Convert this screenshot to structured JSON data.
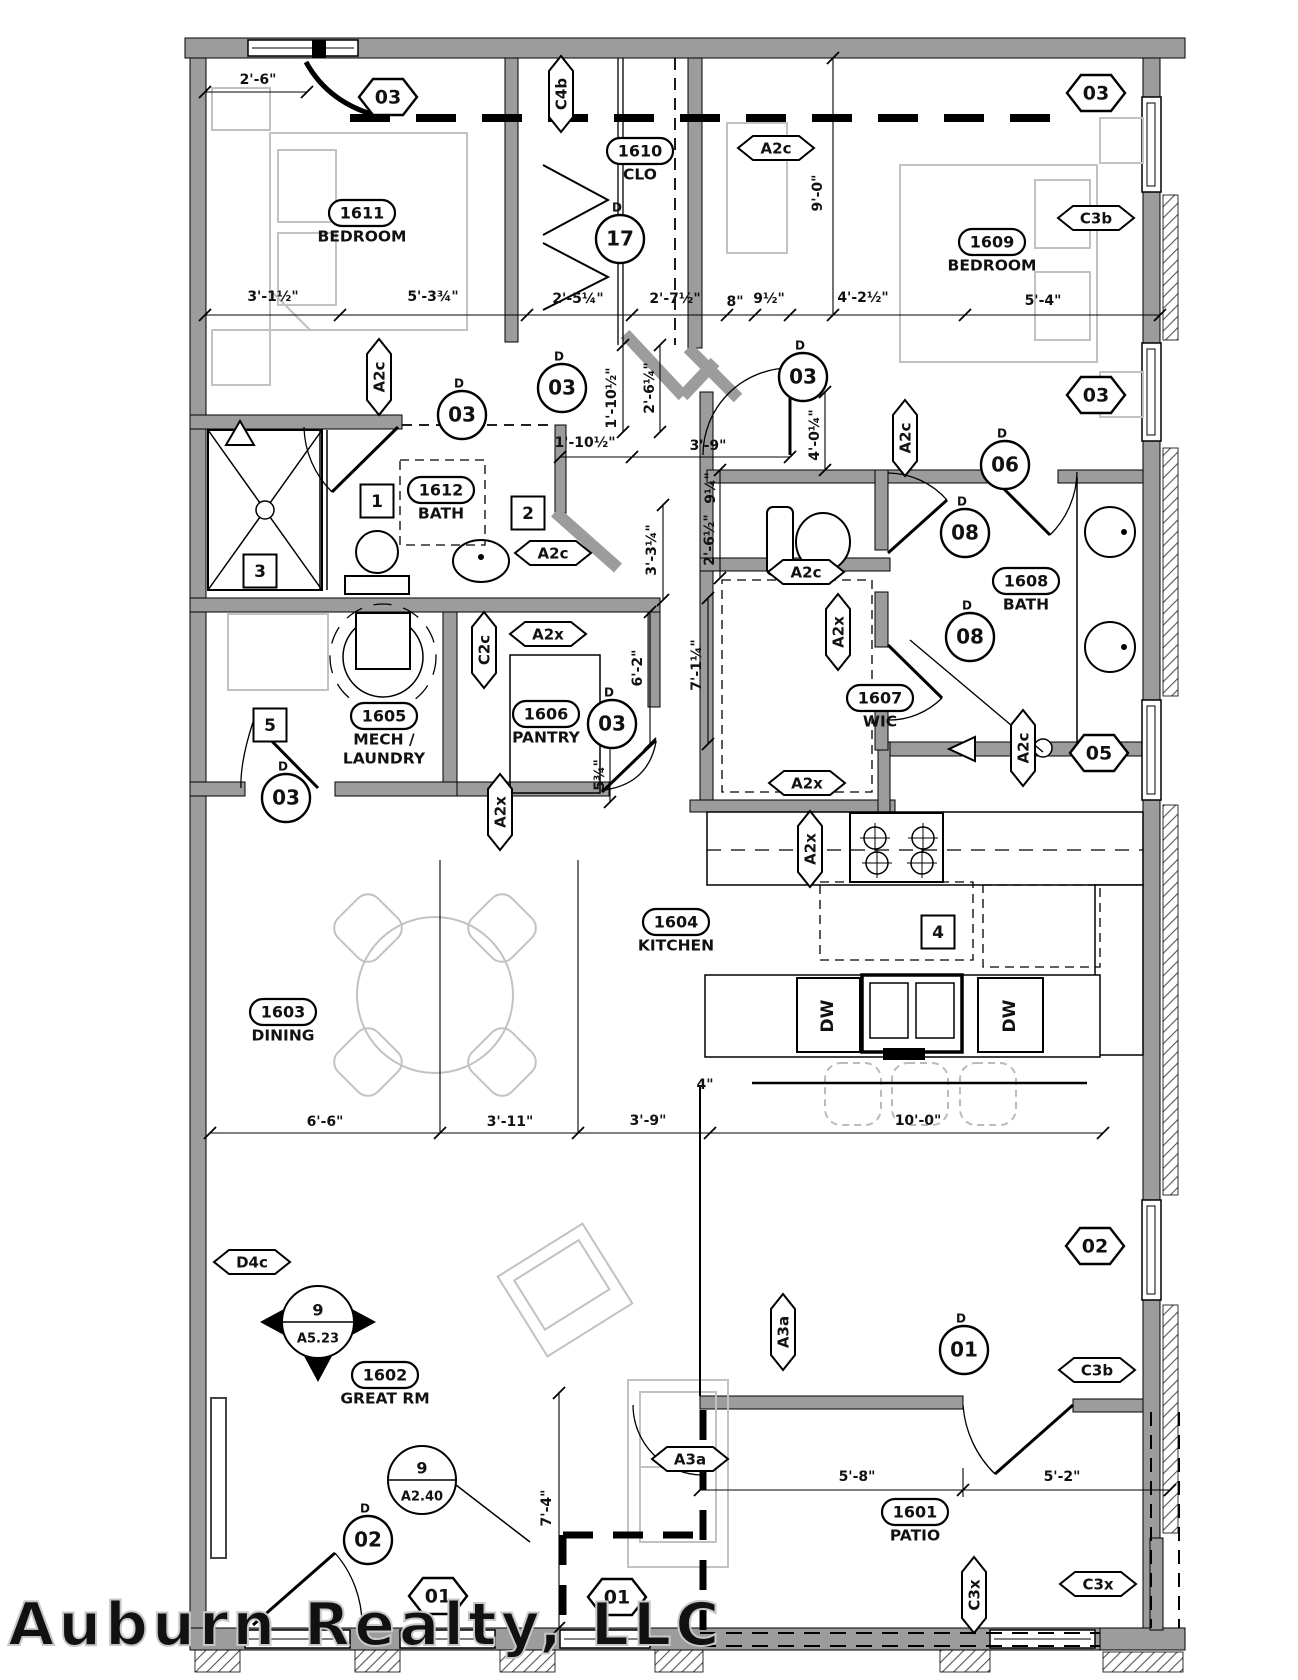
{
  "watermark": "Auburn Realty, LLC",
  "door_letter": "D",
  "colors": {
    "wall_gray": "#9c9c9c",
    "furniture_gray": "#c2c2c2",
    "line": "#111111",
    "watermark_gray": "#c8c8c8"
  },
  "rooms": [
    {
      "num": "1611",
      "name": "BEDROOM",
      "x": 362,
      "y": 213
    },
    {
      "num": "1610",
      "name": "CLO",
      "x": 640,
      "y": 151
    },
    {
      "num": "1609",
      "name": "BEDROOM",
      "x": 992,
      "y": 242
    },
    {
      "num": "1612",
      "name": "BATH",
      "x": 441,
      "y": 490
    },
    {
      "num": "1608",
      "name": "BATH",
      "x": 1026,
      "y": 581
    },
    {
      "num": "1607",
      "name": "WIC",
      "x": 880,
      "y": 698
    },
    {
      "num": "1605",
      "name": "MECH /",
      "name2": "LAUNDRY",
      "x": 384,
      "y": 716
    },
    {
      "num": "1606",
      "name": "PANTRY",
      "x": 546,
      "y": 714
    },
    {
      "num": "1604",
      "name": "KITCHEN",
      "x": 676,
      "y": 922
    },
    {
      "num": "1603",
      "name": "DINING",
      "x": 283,
      "y": 1012
    },
    {
      "num": "1602",
      "name": "GREAT RM",
      "x": 385,
      "y": 1375
    },
    {
      "num": "1601",
      "name": "PATIO",
      "x": 915,
      "y": 1512
    }
  ],
  "door_tags": [
    {
      "n": "17",
      "x": 620,
      "y": 239
    },
    {
      "n": "03",
      "x": 462,
      "y": 415
    },
    {
      "n": "03",
      "x": 562,
      "y": 388
    },
    {
      "n": "03",
      "x": 803,
      "y": 377
    },
    {
      "n": "03",
      "x": 286,
      "y": 798
    },
    {
      "n": "03",
      "x": 612,
      "y": 724
    },
    {
      "n": "06",
      "x": 1005,
      "y": 465
    },
    {
      "n": "08",
      "x": 965,
      "y": 533
    },
    {
      "n": "08",
      "x": 970,
      "y": 637
    },
    {
      "n": "01",
      "x": 964,
      "y": 1350
    },
    {
      "n": "02",
      "x": 368,
      "y": 1540
    }
  ],
  "window_tags": [
    {
      "n": "03",
      "x": 388,
      "y": 97
    },
    {
      "n": "03",
      "x": 1096,
      "y": 93
    },
    {
      "n": "03",
      "x": 1096,
      "y": 395
    },
    {
      "n": "05",
      "x": 1099,
      "y": 753
    },
    {
      "n": "02",
      "x": 1095,
      "y": 1246
    },
    {
      "n": "01",
      "x": 438,
      "y": 1596
    },
    {
      "n": "01",
      "x": 617,
      "y": 1597
    }
  ],
  "wall_tags": [
    {
      "t": "C4b",
      "x": 561,
      "y": 94,
      "v": 1
    },
    {
      "t": "A2c",
      "x": 776,
      "y": 148
    },
    {
      "t": "A2c",
      "x": 379,
      "y": 377,
      "v": 1
    },
    {
      "t": "A2c",
      "x": 553,
      "y": 553
    },
    {
      "t": "A2c",
      "x": 806,
      "y": 572
    },
    {
      "t": "A2c",
      "x": 905,
      "y": 438,
      "v": 1
    },
    {
      "t": "A2x",
      "x": 838,
      "y": 632,
      "v": 1
    },
    {
      "t": "A2x",
      "x": 548,
      "y": 634
    },
    {
      "t": "C2c",
      "x": 484,
      "y": 650,
      "v": 1
    },
    {
      "t": "A2x",
      "x": 807,
      "y": 783
    },
    {
      "t": "A2x",
      "x": 810,
      "y": 849,
      "v": 1
    },
    {
      "t": "A2x",
      "x": 500,
      "y": 812,
      "v": 1
    },
    {
      "t": "A2c",
      "x": 1023,
      "y": 748,
      "v": 1
    },
    {
      "t": "D4c",
      "x": 252,
      "y": 1262
    },
    {
      "t": "A3a",
      "x": 783,
      "y": 1332,
      "v": 1
    },
    {
      "t": "A3a",
      "x": 690,
      "y": 1459
    },
    {
      "t": "C3b",
      "x": 1096,
      "y": 218
    },
    {
      "t": "C3b",
      "x": 1097,
      "y": 1370
    },
    {
      "t": "C3x",
      "x": 974,
      "y": 1595,
      "v": 1
    },
    {
      "t": "C3x",
      "x": 1098,
      "y": 1584
    }
  ],
  "keynotes": [
    {
      "n": "1",
      "x": 377,
      "y": 501
    },
    {
      "n": "2",
      "x": 528,
      "y": 513
    },
    {
      "n": "3",
      "x": 260,
      "y": 571
    },
    {
      "n": "5",
      "x": 270,
      "y": 725
    },
    {
      "n": "4",
      "x": 938,
      "y": 932
    }
  ],
  "dims": [
    {
      "t": "2'-6\"",
      "x": 258,
      "y": 80
    },
    {
      "t": "3'-1½\"",
      "x": 273,
      "y": 297
    },
    {
      "t": "5'-3¾\"",
      "x": 433,
      "y": 297
    },
    {
      "t": "2'-5¼\"",
      "x": 578,
      "y": 299
    },
    {
      "t": "2'-7½\"",
      "x": 675,
      "y": 299
    },
    {
      "t": "8\"",
      "x": 735,
      "y": 302
    },
    {
      "t": "9½\"",
      "x": 769,
      "y": 299
    },
    {
      "t": "4'-2½\"",
      "x": 863,
      "y": 298
    },
    {
      "t": "5'-4\"",
      "x": 1043,
      "y": 301
    },
    {
      "t": "9'-0\"",
      "x": 818,
      "y": 193,
      "v": 1
    },
    {
      "t": "1'-10½\"",
      "x": 612,
      "y": 398,
      "v": 1
    },
    {
      "t": "2'-6¼\"",
      "x": 650,
      "y": 388,
      "v": 1
    },
    {
      "t": "1'-10½\"",
      "x": 585,
      "y": 443
    },
    {
      "t": "3'-9\"",
      "x": 708,
      "y": 446
    },
    {
      "t": "4'-0¼\"",
      "x": 815,
      "y": 435,
      "v": 1
    },
    {
      "t": "9¼\"",
      "x": 711,
      "y": 488,
      "v": 1
    },
    {
      "t": "2'-6½\"",
      "x": 710,
      "y": 540,
      "v": 1
    },
    {
      "t": "3'-3¼\"",
      "x": 652,
      "y": 550,
      "v": 1
    },
    {
      "t": "7'-1¼\"",
      "x": 697,
      "y": 665,
      "v": 1
    },
    {
      "t": "6'-2\"",
      "x": 638,
      "y": 668,
      "v": 1
    },
    {
      "t": "5¾\"",
      "x": 600,
      "y": 775,
      "v": 1
    },
    {
      "t": "6'-6\"",
      "x": 325,
      "y": 1122
    },
    {
      "t": "3'-11\"",
      "x": 510,
      "y": 1122
    },
    {
      "t": "3'-9\"",
      "x": 648,
      "y": 1121
    },
    {
      "t": "10'-0\"",
      "x": 918,
      "y": 1121
    },
    {
      "t": "4\"",
      "x": 705,
      "y": 1085
    },
    {
      "t": "5'-8\"",
      "x": 857,
      "y": 1477
    },
    {
      "t": "5'-2\"",
      "x": 1062,
      "y": 1477
    },
    {
      "t": "7'-4\"",
      "x": 547,
      "y": 1508,
      "v": 1
    }
  ],
  "markers": [
    {
      "top": "9",
      "bot": "A5.23",
      "x": 318,
      "y": 1322,
      "kind": "section"
    },
    {
      "top": "9",
      "bot": "A2.40",
      "x": 422,
      "y": 1480,
      "kind": "detail"
    }
  ],
  "appliances": [
    {
      "t": "DW",
      "x": 828,
      "y": 1016,
      "v": 1
    },
    {
      "t": "DW",
      "x": 1010,
      "y": 1016,
      "v": 1
    }
  ]
}
